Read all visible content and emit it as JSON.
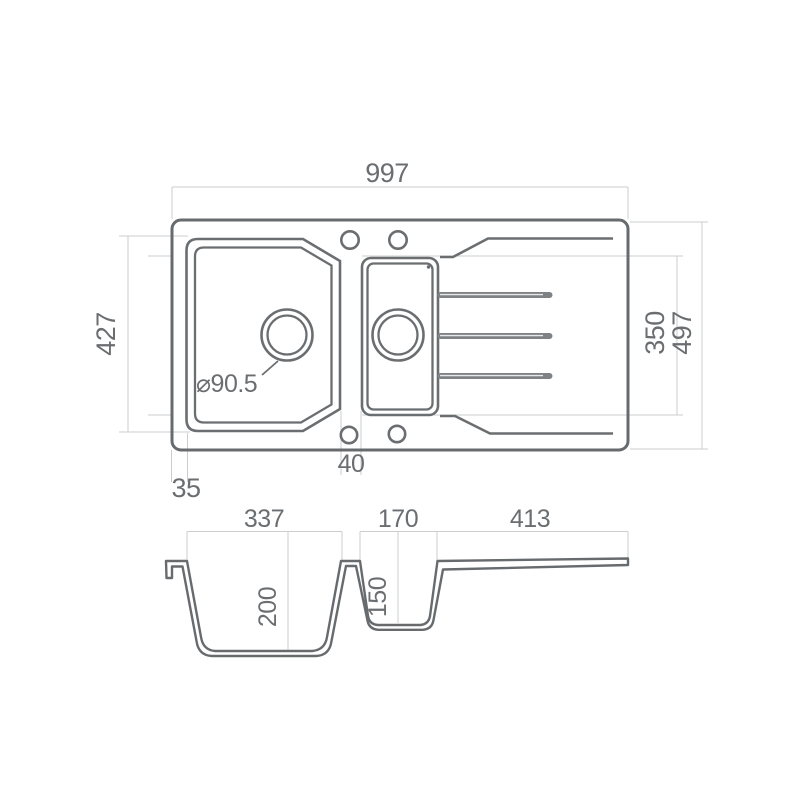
{
  "drawing_type": "sink technical drawing, top view and cross-section",
  "colors": {
    "line": "#686b6e",
    "dimension_line": "#cbcdce",
    "text": "#6b6e71",
    "background": "#ffffff"
  },
  "top_view": {
    "overall_width": "997",
    "bowl_length": "427",
    "right_section_length": "350",
    "overall_depth": "497",
    "rim_offset": "35",
    "divider_width": "40",
    "drain_diameter": "⌀90.5"
  },
  "section_view": {
    "main_bowl_width": "337",
    "half_bowl_width": "170",
    "drainboard_width": "413",
    "main_bowl_depth": "200",
    "half_bowl_depth": "150"
  }
}
